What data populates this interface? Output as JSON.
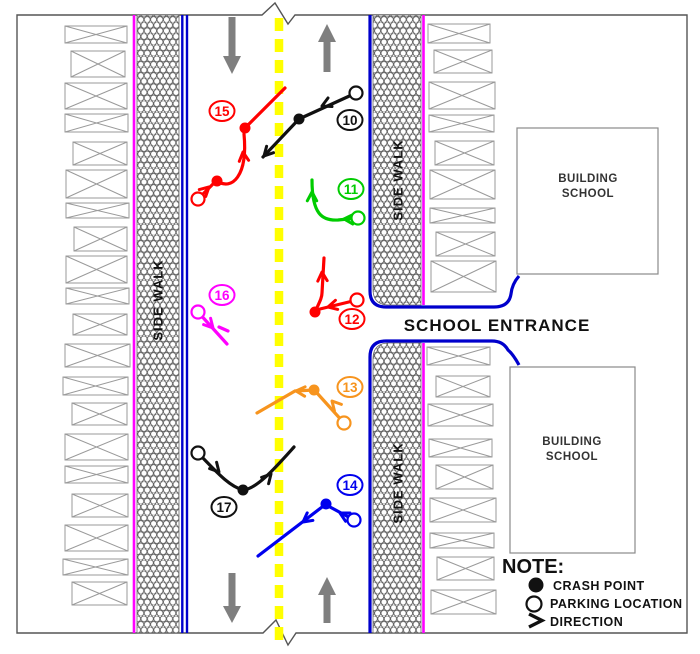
{
  "diagram": {
    "labels": {
      "side_walk": "SIDE WALK",
      "school_entrance": "SCHOOL ENTRANCE",
      "building_line1": "BUILDING",
      "building_line2": "SCHOOL"
    },
    "note": {
      "title": "NOTE:",
      "items": [
        {
          "marker": "crash-point",
          "label": "CRASH POINT"
        },
        {
          "marker": "parking-location",
          "label": "PARKING LOCATION"
        },
        {
          "marker": "direction",
          "label": "DIRECTION"
        }
      ]
    },
    "colors": {
      "center_line": "#FFFF00",
      "curb": "#0000CC",
      "property_line": "#FF00FF",
      "lane_arrow": "#7F7F7F",
      "stall_outline": "#9A9A9A",
      "frame": "#555555"
    },
    "cases": [
      {
        "id": "15",
        "color": "#FF0000",
        "label": [
          222,
          111
        ],
        "parking": [
          198,
          199
        ],
        "crashes": [
          [
            217,
            181
          ],
          [
            245,
            128
          ]
        ],
        "paths": [
          "M198,199 L215,182",
          "M217,181 C232,191 248,176 244,134",
          "M245,128 L285,88"
        ],
        "arrows": [
          [
            209,
            187,
            -43
          ],
          [
            243,
            152,
            -96
          ]
        ]
      },
      {
        "id": "10",
        "color": "#111111",
        "label": [
          350,
          120
        ],
        "parking": [
          356,
          93
        ],
        "crashes": [
          [
            299,
            119
          ]
        ],
        "paths": [
          "M356,93 L299,119 L263,157"
        ],
        "arrows": [
          [
            322,
            106,
            155
          ],
          [
            264,
            156,
            133
          ]
        ]
      },
      {
        "id": "11",
        "color": "#00CC00",
        "label": [
          351,
          189
        ],
        "parking": [
          358,
          218
        ],
        "crashes": [],
        "paths": [
          "M358,218 L338,220 C322,221 312,214 312,180"
        ],
        "arrows": [
          [
            344,
            219,
            182
          ],
          [
            312,
            192,
            -90
          ]
        ]
      },
      {
        "id": "16",
        "color": "#FF00FF",
        "label": [
          222,
          295
        ],
        "parking": [
          198,
          312
        ],
        "crashes": [],
        "paths": [
          "M198,312 L227,344",
          "M219,327 L228,331"
        ],
        "arrows": [
          [
            213,
            328,
            48
          ]
        ]
      },
      {
        "id": "12",
        "color": "#FF0000",
        "label": [
          352,
          319
        ],
        "parking": [
          357,
          300
        ],
        "crashes": [
          [
            315,
            312
          ]
        ],
        "paths": [
          "M357,300 L320,309",
          "M315,312 C319,303 322,298 322,293 L324,258"
        ],
        "arrows": [
          [
            328,
            307,
            166
          ],
          [
            322,
            272,
            -93
          ]
        ]
      },
      {
        "id": "13",
        "color": "#F7941E",
        "label": [
          350,
          387
        ],
        "parking": [
          344,
          423
        ],
        "crashes": [
          [
            314,
            390
          ]
        ],
        "paths": [
          "M344,423 L317,393",
          "M314,390 L295,391 L257,413"
        ],
        "arrows": [
          [
            332,
            401,
            -132
          ],
          [
            296,
            391,
            183
          ]
        ]
      },
      {
        "id": "14",
        "color": "#0000EE",
        "label": [
          350,
          485
        ],
        "parking": [
          354,
          520
        ],
        "crashes": [
          [
            326,
            504
          ]
        ],
        "paths": [
          "M354,520 L330,507",
          "M326,504 L258,556"
        ],
        "arrows": [
          [
            340,
            513,
            -152
          ],
          [
            303,
            522,
            143
          ]
        ]
      },
      {
        "id": "17",
        "color": "#111111",
        "label": [
          224,
          507
        ],
        "parking": [
          198,
          453
        ],
        "crashes": [
          [
            243,
            490
          ]
        ],
        "paths": [
          "M198,453 C214,469 228,486 243,490",
          "M243,490 C257,489 276,467 294,447"
        ],
        "arrows": [
          [
            219,
            472,
            48
          ],
          [
            271,
            474,
            -48
          ]
        ]
      }
    ],
    "parking_stalls": {
      "left": [
        [
          65,
          26,
          62,
          17
        ],
        [
          71,
          51,
          54,
          26
        ],
        [
          65,
          83,
          62,
          26
        ],
        [
          65,
          114,
          63,
          18
        ],
        [
          73,
          142,
          54,
          23
        ],
        [
          66,
          170,
          61,
          28
        ],
        [
          66,
          203,
          63,
          15
        ],
        [
          74,
          227,
          53,
          24
        ],
        [
          66,
          256,
          61,
          27
        ],
        [
          66,
          288,
          63,
          16
        ],
        [
          73,
          314,
          54,
          21
        ],
        [
          65,
          344,
          65,
          23
        ],
        [
          63,
          377,
          65,
          18
        ],
        [
          72,
          403,
          55,
          22
        ],
        [
          65,
          434,
          63,
          26
        ],
        [
          65,
          466,
          63,
          17
        ],
        [
          72,
          494,
          56,
          23
        ],
        [
          65,
          525,
          63,
          26
        ],
        [
          63,
          559,
          65,
          16
        ],
        [
          72,
          582,
          55,
          23
        ]
      ],
      "right_top": [
        [
          428,
          24,
          62,
          19
        ],
        [
          434,
          50,
          58,
          23
        ],
        [
          429,
          82,
          66,
          27
        ],
        [
          429,
          115,
          65,
          17
        ],
        [
          435,
          141,
          59,
          24
        ],
        [
          430,
          170,
          65,
          29
        ],
        [
          430,
          208,
          65,
          15
        ],
        [
          436,
          232,
          59,
          24
        ],
        [
          431,
          261,
          65,
          31
        ]
      ],
      "right_bottom": [
        [
          427,
          347,
          63,
          18
        ],
        [
          436,
          376,
          54,
          21
        ],
        [
          428,
          404,
          65,
          22
        ],
        [
          429,
          439,
          63,
          18
        ],
        [
          436,
          465,
          57,
          24
        ],
        [
          430,
          498,
          66,
          24
        ],
        [
          430,
          533,
          64,
          15
        ],
        [
          437,
          557,
          57,
          23
        ],
        [
          431,
          590,
          65,
          24
        ]
      ]
    }
  }
}
